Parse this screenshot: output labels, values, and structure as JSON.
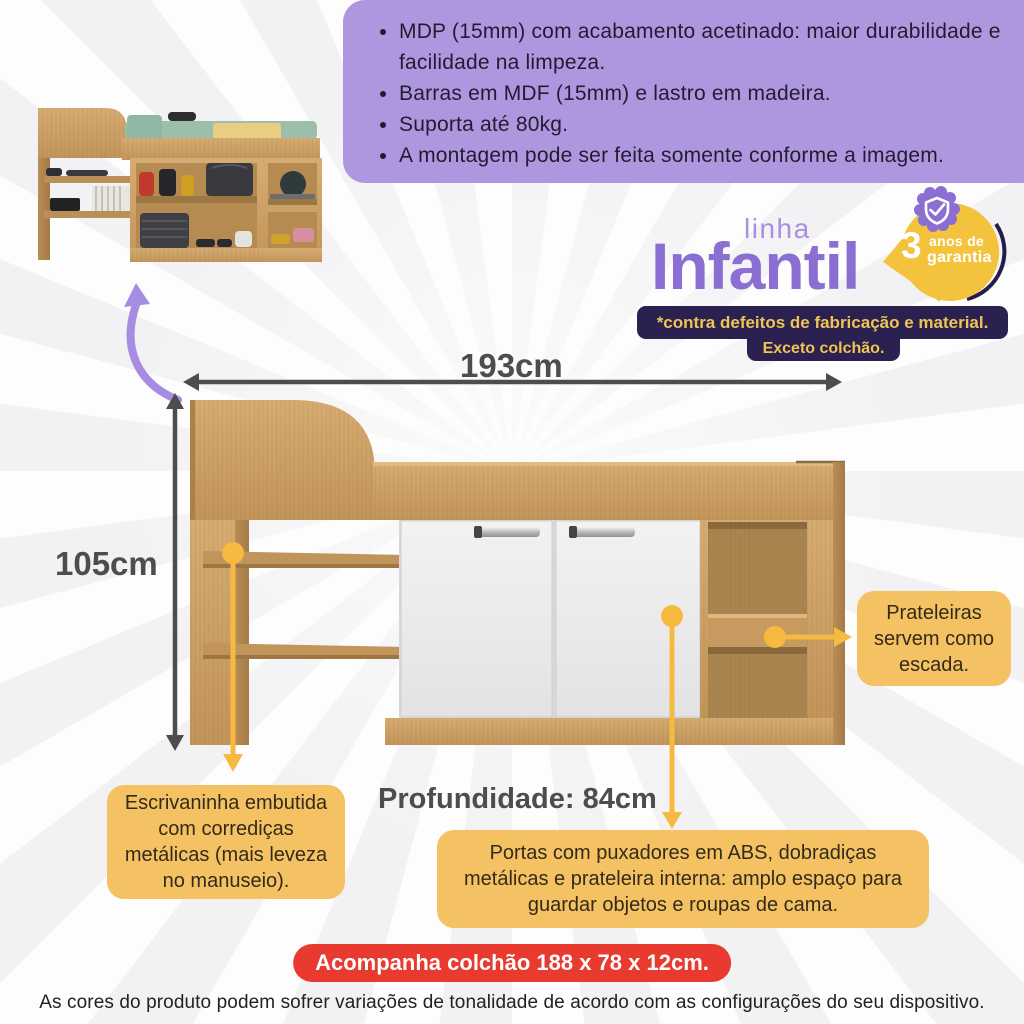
{
  "info_box": {
    "bullets": [
      "MDP (15mm) com acabamento acetinado: maior durabilidade e facilidade na limpeza.",
      "Barras em MDF (15mm) e lastro em madeira.",
      "Suporta até 80kg.",
      "A montagem pode ser feita somente conforme a imagem."
    ]
  },
  "brand": {
    "line_top": "linha",
    "line_main": "Infantil",
    "badge": {
      "number": "3",
      "text1": "anos de",
      "text2": "garantia"
    }
  },
  "warranty": {
    "line1": "*contra defeitos de fabricação e material.",
    "line2": "Exceto colchão."
  },
  "dimensions": {
    "width": "193cm",
    "height": "105cm",
    "depth": "Profundidade: 84cm"
  },
  "callouts": {
    "desk": "Escrivaninha embutida com corrediças metálicas (mais leveza no manuseio).",
    "doors": "Portas com puxadores em ABS, dobradiças metálicas e prateleira interna: amplo espaço para guardar objetos e roupas de cama.",
    "shelves": "Prateleiras servem como escada."
  },
  "mattress_note": "Acompanha colchão 188 x 78 x 12cm.",
  "footer_note": "As cores do produto podem sofrer variações de tonalidade de acordo com as configurações do seu dispositivo.",
  "icons": {
    "shield": "shield-check-icon",
    "curved_arrow": "curved-arrow-icon"
  },
  "colors": {
    "purple_box": "#af97e0",
    "brand_purple": "#8a6ed2",
    "badge_yellow": "#f3c33e",
    "navy": "#2a2150",
    "callout_yellow": "#f4c263",
    "red": "#e83a2f",
    "wood": "#c89b61",
    "dim_gray": "#4d4d4d"
  }
}
